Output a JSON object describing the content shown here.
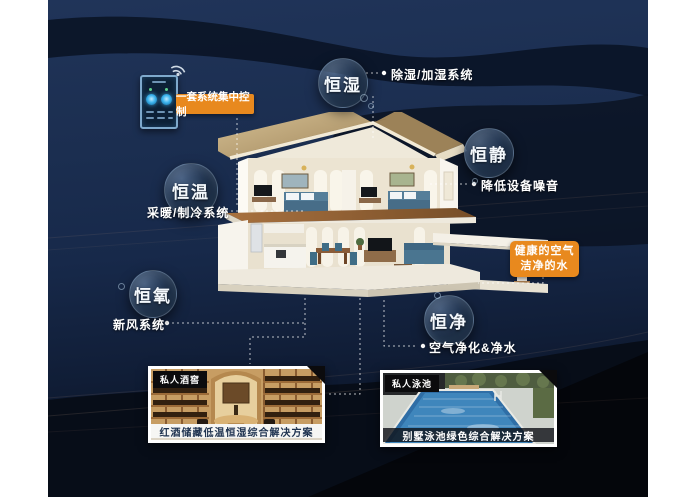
{
  "poster": {
    "control_panel": {
      "label": "一套系统集中控制"
    },
    "features": [
      {
        "name": "恒湿",
        "note": "除湿/加湿系统"
      },
      {
        "name": "恒静",
        "note": "降低设备噪音"
      },
      {
        "name": "恒温",
        "note": "采暖/制冷系统"
      },
      {
        "name": "恒氧",
        "note": "新风系统"
      },
      {
        "name": "恒净",
        "note": "空气净化&净水"
      }
    ],
    "highlight": {
      "line1": "健康的空气",
      "line2": "洁净的水"
    },
    "cards": [
      {
        "tag": "私人酒窖",
        "caption": "红酒储藏低温恒湿综合解决方案"
      },
      {
        "tag": "私人泳池",
        "caption": "别墅泳池绿色综合解决方案"
      }
    ],
    "colors": {
      "accent_orange": "#E8891E",
      "background_navy": "#1B2E50",
      "bubble_dark": "#0E1828"
    }
  }
}
